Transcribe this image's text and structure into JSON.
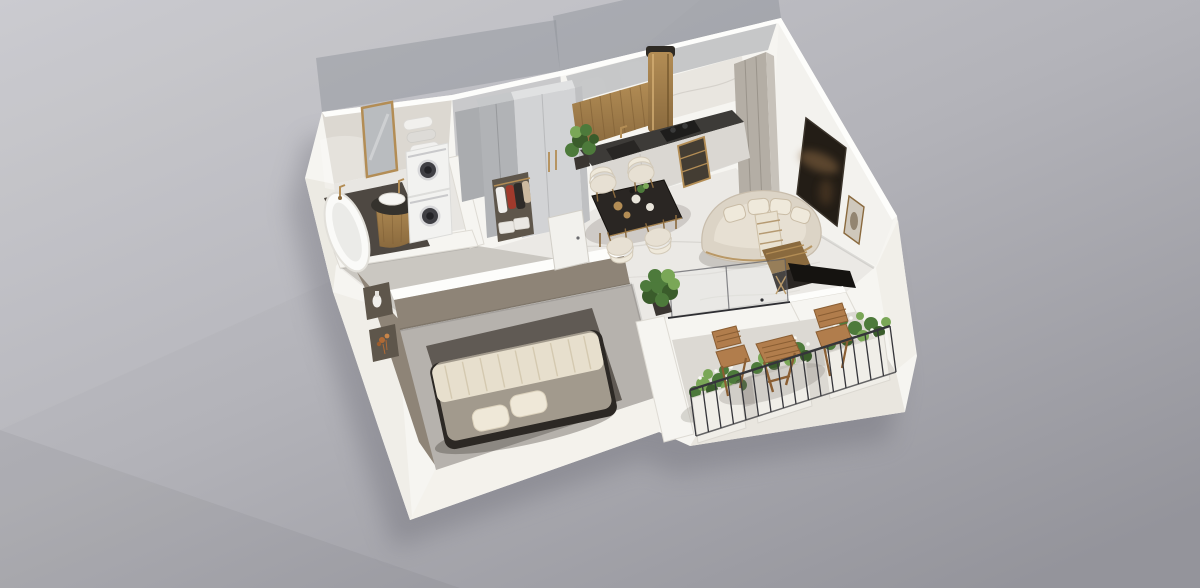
{
  "meta": {
    "description": "Photorealistic axonometric cutaway 3D floor plan rendering of a one-bedroom apartment on a plain gray studio background. No text, UI controls or labels are visible in the image."
  },
  "scene": {
    "type": "3d-floorplan-render",
    "projection": "axonometric cutaway, walls cut at partial height, some rear walls translucent",
    "rooms": [
      {
        "name": "bathroom",
        "position": "top-left",
        "items": [
          "freestanding-bathtub",
          "gold-floor-faucet",
          "round-pedestal-sink",
          "gold-framed-mirror",
          "rolled-towel-shelves",
          "stacked-washer-dryer",
          "dark-floor-mat"
        ]
      },
      {
        "name": "hallway",
        "position": "top-center-left",
        "items": [
          "gray-wardrobe",
          "light-closet-with-gold-handles",
          "open-clothes-rack",
          "storage-boxes",
          "white-interior-door"
        ]
      },
      {
        "name": "kitchen",
        "position": "top-center",
        "items": [
          "dark-stone-countertop",
          "sink-with-gold-faucet",
          "black-cooktop",
          "cylindrical-brass-range-hood",
          "gold-slat-backsplash",
          "marble-backsplash",
          "tall-greige-cabinets",
          "gold-open-shelf",
          "potted-plant"
        ]
      },
      {
        "name": "dining-area",
        "position": "center",
        "items": [
          "dark-marble-dining-table",
          "four-cream-chairs",
          "table-place-settings"
        ]
      },
      {
        "name": "living-room",
        "position": "right",
        "items": [
          "curved-cream-sofa",
          "four-throw-pillows",
          "striped-throw-blanket",
          "large-dark-wall-artwork",
          "leaning-floor-frame",
          "dark-console-desk-with-gold-legs"
        ]
      },
      {
        "name": "corridor",
        "position": "center-bottom",
        "items": [
          "potted-green-shrub",
          "sliding-glass-balcony-door"
        ]
      },
      {
        "name": "bedroom",
        "position": "bottom-left",
        "items": [
          "double-bed",
          "cream-pleated-throw",
          "two-pillows",
          "dark-bed-frame",
          "charcoal-area-rug",
          "wall-niche-with-vase",
          "wall-niche-with-copper-flowers"
        ]
      },
      {
        "name": "balcony",
        "position": "bottom-right",
        "items": [
          "wooden-folding-table",
          "two-wooden-folding-chairs",
          "three-white-planter-boxes",
          "green-plants-with-white-flowers",
          "black-metal-railing"
        ]
      }
    ]
  },
  "palette": {
    "bg_top": "#c9c9ce",
    "bg_mid": "#b3b3b9",
    "bg_bottom": "#94949b",
    "ground_shadow": "#5f5f69",
    "wall_white": "#f6f5f1",
    "wall_top": "#fdfdfb",
    "wall_shade": "#eceae3",
    "wall_edge": "#d9d6cf",
    "ghost_wall": "#8b9097",
    "bath_back": "#dcd8d1",
    "hall_back": "#c9c9cb",
    "marble_floor": "#ebe9e5",
    "marble_vein": "#d2cfca",
    "entry_floor": "#c7c3bc",
    "concrete_floor": "#b6b2ad",
    "rug": "#5d5751",
    "taupe_wall": "#8e8477",
    "taupe_deep": "#776f63",
    "counter_top": "#3d3b38",
    "cooktop": "#1e1d1c",
    "cabinet_front": "#dad7d2",
    "cabinet_gray": "#b1b3b6",
    "closet_light": "#d2d3d5",
    "gold": "#b38d55",
    "gold_deep": "#8a6a3e",
    "marble_back": "#e9e6e0",
    "sofa": "#dcd4c6",
    "sofa_shade": "#c8bdac",
    "cushion": "#efe9db",
    "art_dark": "#231d16",
    "art_glow": "#8a6843",
    "frame_light": "#cfc8bc",
    "table_dark": "#2a2623",
    "chair_cream": "#e7e0d3",
    "wood": "#b17d4c",
    "wood_deep": "#8a5e33",
    "plant": "#4d7a3b",
    "plant_light": "#7aa757",
    "plant_deep": "#3a5c2b",
    "flower": "#f8f8f3",
    "railing": "#35353a",
    "planter": "#f0eee8",
    "balcony_floor": "#dcd9d3",
    "tub": "#fafaf8",
    "dark_mat": "#4e4842",
    "machine": "#f2f2f0",
    "machine_door": "#3f3f44",
    "bed_duvet": "#a29a8d",
    "bed_throw": "#e7dfcd",
    "pillow": "#efe8d8",
    "bed_frame": "#2c2824",
    "door_white": "#f2f1ed",
    "niche_dark": "#5e564b",
    "copper": "#b06a35",
    "glass_tint": "#dde4e8",
    "mirror_glass": "#b9bcbf",
    "cloth_red": "#a03a2c",
    "cloth_dark": "#2e2b28"
  }
}
